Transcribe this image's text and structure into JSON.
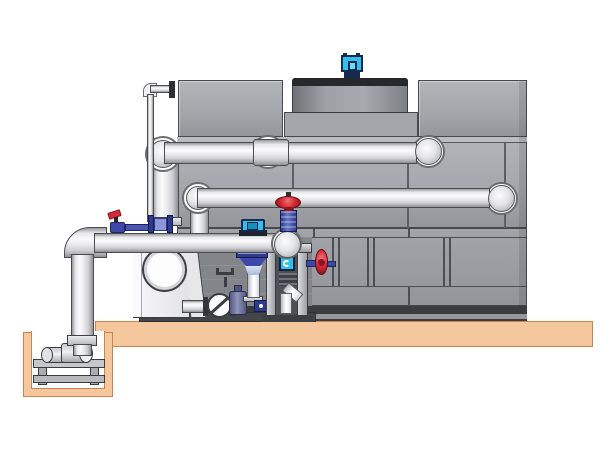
{
  "scene": {
    "description": "technical illustration of a factory-assembled cooling tower with external piping, pump skid and sump pit",
    "visible_text": "none"
  },
  "palette": {
    "bg": "#ffffff",
    "panel": "#a6a8ae",
    "seam": "#46484c",
    "deck": "#a4a6ac",
    "cowl_rim": "#26282c",
    "motor_navy": "#16294e",
    "cyan": "#2fc0ee",
    "pipe_outline": "#4a4c50",
    "tan": "#f5c79d",
    "tan_edge": "#c9834f",
    "skid_dark": "#43454a",
    "valve_red": "#d62a35",
    "valve_red_dark": "#8e1420",
    "valve_blue": "#3d49a8",
    "valve_blue_light": "#8d96da",
    "frame_cavity": "#4e5056",
    "housing": "#f0f0f2"
  },
  "components": {
    "tower": "cooling-tower-casing",
    "fan_motor": "fan-motor",
    "fan_cowl": "fan-cowl",
    "upper_pipe": "upper-inlet-header-pipe",
    "mid_pipe": "middle-inlet-header-pipe",
    "header_pipe": "pump-discharge-header-pipe",
    "suction_pipe": "sump-suction-riser",
    "makeup_line": "makeup-water-line",
    "sump_pit": "sump-pit",
    "sump_pump": "sump-pump-set",
    "pump_housing": "pump-volute-housing",
    "check_valve": "wafer-check-valve",
    "gate_valve": "gate-valve",
    "globe_valve": "globe-valve-red-handwheel",
    "side_valve": "side-handwheel-valve",
    "sample_valve": "sample-valve",
    "flow_sensor": "flow-sensor",
    "drain_funnel": "drain-funnel",
    "instrument_frame": "instrument-frame",
    "platform": "equipment-platform"
  }
}
